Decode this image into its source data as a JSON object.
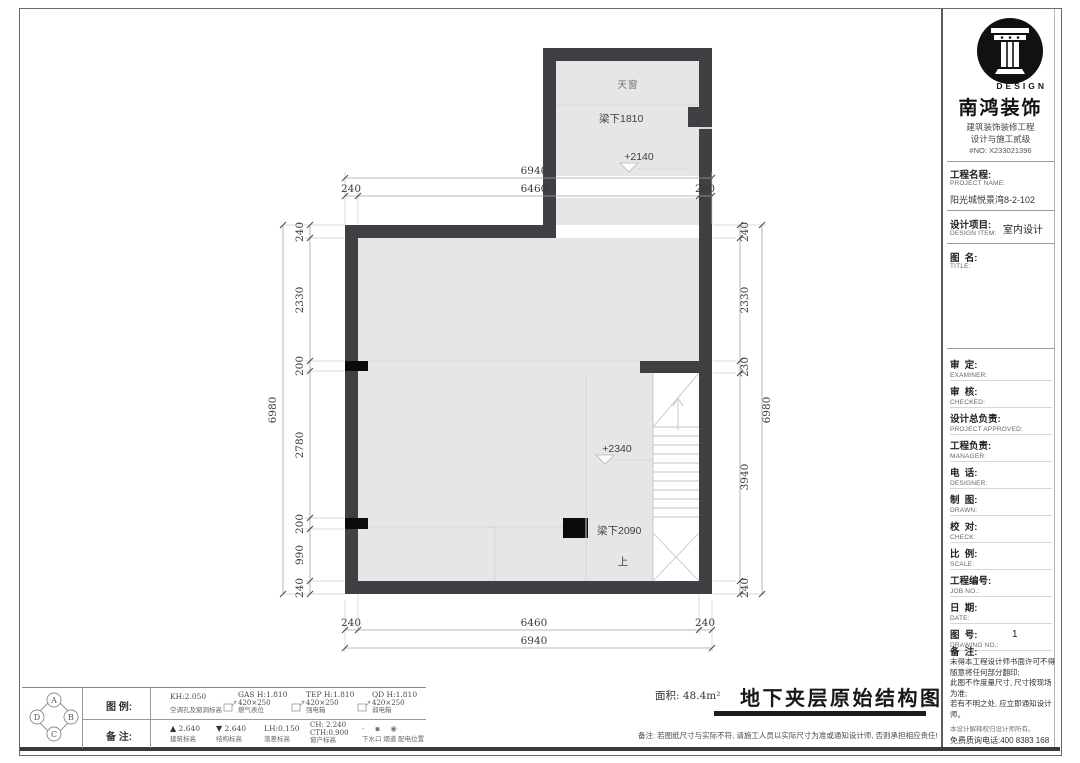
{
  "plan": {
    "labels": {
      "skylight": "天窗",
      "beam_top": "梁下1810",
      "level_top": "+2140",
      "level_main": "+2340",
      "beam_main": "梁下2090",
      "stair_up": "上"
    },
    "dims": {
      "top_total": "6940",
      "top_segments": [
        "240",
        "6460",
        "240"
      ],
      "bottom_segments": [
        "240",
        "6460",
        "240"
      ],
      "bottom_total": "6940",
      "left_total": "6980",
      "left_segments": [
        "240",
        "2330",
        "200",
        "2780",
        "200",
        "990",
        "240"
      ],
      "right_total": "6980",
      "right_segments": [
        "240",
        "2330",
        "230",
        "3940",
        "240"
      ]
    }
  },
  "legend": {
    "legend_label": "图 例:",
    "notes_label": "备 注:",
    "compass": [
      "A",
      "B",
      "C",
      "D"
    ],
    "items": [
      {
        "code": "KH:2.050",
        "size": "",
        "name": "空调孔及窗洞标高"
      },
      {
        "code": "GAS H:1.810",
        "size": "420×250",
        "name": "燃气表位"
      },
      {
        "code": "TEP H:1.810",
        "size": "420×250",
        "name": "强电箱"
      },
      {
        "code": "QD H:1.810",
        "size": "420×250",
        "name": "弱电箱"
      }
    ],
    "notes": [
      {
        "symbol": "▲",
        "code": "2.640",
        "name": "建筑标高"
      },
      {
        "symbol": "▼",
        "code": "2.640",
        "name": "结构标高"
      },
      {
        "symbol": "",
        "code": "LH:0.150",
        "name": "落差标高"
      },
      {
        "symbol": "",
        "code": "CH: 2.240",
        "code2": "CTH:0.900",
        "name": "窗户标高"
      },
      {
        "symbol": "‐ ▪ ◉",
        "code": "",
        "name": "下水口 烟道 配电位置"
      }
    ]
  },
  "footer": {
    "area_label": "面积: 48.4m²",
    "drawing_title": "地下夹层原始结构图",
    "note": "备注: 若图纸尺寸与实际不符, 请施工人员以实际尺寸为准或通知设计师, 否则承担相应责任!"
  },
  "title_block": {
    "brand_en": "DESIGN",
    "brand": "南鸿装饰",
    "cert_line1": "建筑装饰装修工程",
    "cert_line2": "设计与施工贰级",
    "cert_no": "#NO: X233021396",
    "project": {
      "cn": "工程名程:",
      "en": "PROJECT NAME:",
      "value": "阳光城悦景湾8-2-102"
    },
    "design_item": {
      "cn": "设计项目:",
      "en": "DESIGN ITEM:",
      "value": "室内设计"
    },
    "drawing_name": {
      "cn": "图  名:",
      "en": "TITLE:",
      "value": ""
    },
    "rows": [
      {
        "cn": "审  定:",
        "en": "EXAMINER:",
        "value": ""
      },
      {
        "cn": "审  核:",
        "en": "CHECKED:",
        "value": ""
      },
      {
        "cn": "设计总负责:",
        "en": "PROJECT APPROVED:",
        "value": ""
      },
      {
        "cn": "工程负责:",
        "en": "MANAGER:",
        "value": ""
      },
      {
        "cn": "电  话:",
        "en": "DESIGNER:",
        "value": ""
      },
      {
        "cn": "制  图:",
        "en": "DRAWN:",
        "value": ""
      },
      {
        "cn": "校  对:",
        "en": "CHECK:",
        "value": ""
      },
      {
        "cn": "比  例:",
        "en": "SCALE:",
        "value": ""
      },
      {
        "cn": "工程编号:",
        "en": "JOB NO.:",
        "value": ""
      },
      {
        "cn": "日  期:",
        "en": "DATE:",
        "value": ""
      },
      {
        "cn": "图  号:",
        "en": "DRAWING NO.:",
        "value": "1"
      }
    ],
    "remark_label": "备  注:",
    "remarks": [
      "未得本工程设计师书面许可不得",
      "随意将任何部分翻印;",
      "此图不作度量尺寸, 尺寸按现场",
      "为准;",
      "若有不明之处, 应立即通知设计",
      "师。"
    ],
    "remark_small": "本设计解释权归设计师所有。",
    "hotline": "免费质询电话:400 8383 168"
  }
}
